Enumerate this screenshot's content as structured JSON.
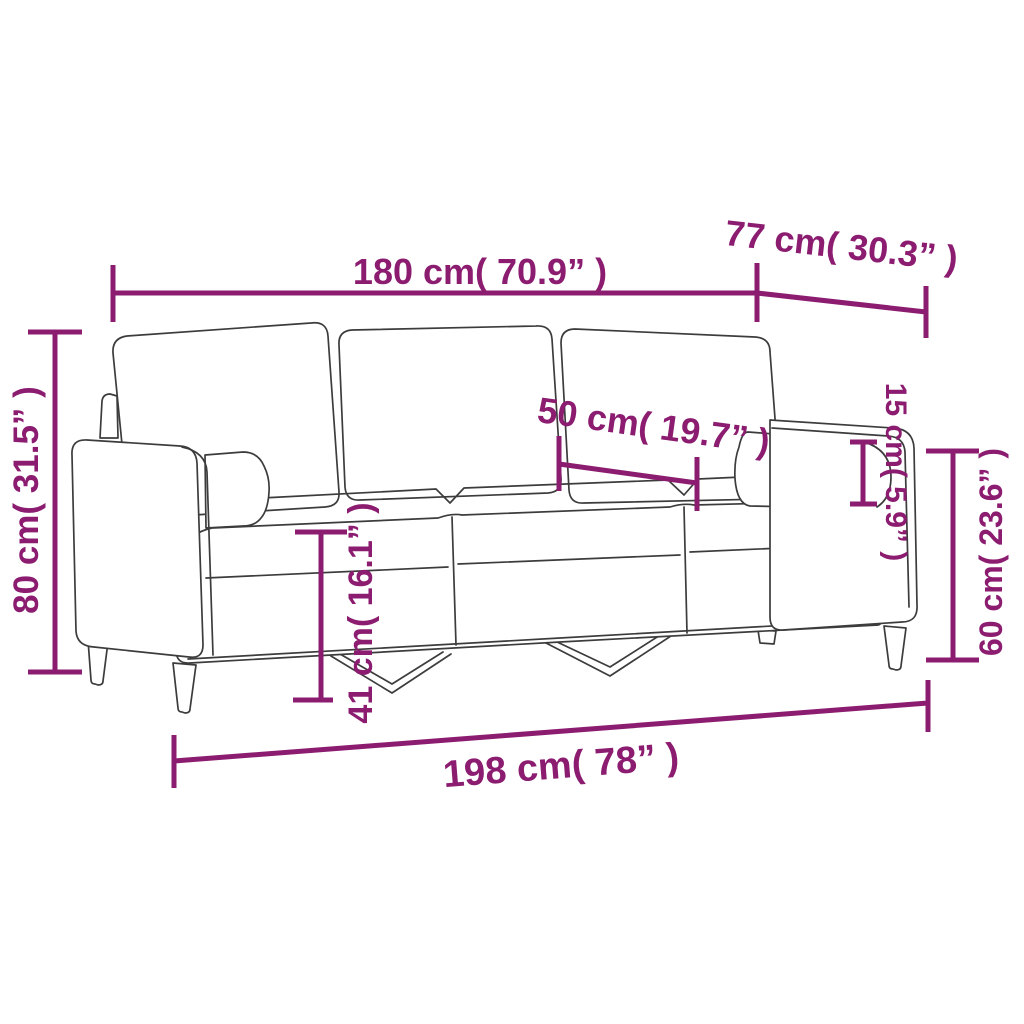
{
  "diagram": {
    "subject": "three-seater sofa with bolster pillows — dimension drawing",
    "accent_color": "#8b1c70",
    "outline_color": "#3c3c3c",
    "background_color": "#ffffff",
    "dimensions": {
      "overall_width": {
        "label": "180 cm( 70.9” )"
      },
      "depth": {
        "label": "77 cm( 30.3” )"
      },
      "overall_height": {
        "label": "80 cm( 31.5” )"
      },
      "seat_depth": {
        "label": "50 cm( 19.7” )"
      },
      "bolster_diameter": {
        "label": "15 cm( 5.9” )"
      },
      "armrest_height": {
        "label": "60 cm( 23.6” )"
      },
      "seat_height": {
        "label": "41 cm( 16.1” )"
      },
      "total_width": {
        "label": "198 cm( 78” )"
      }
    }
  }
}
